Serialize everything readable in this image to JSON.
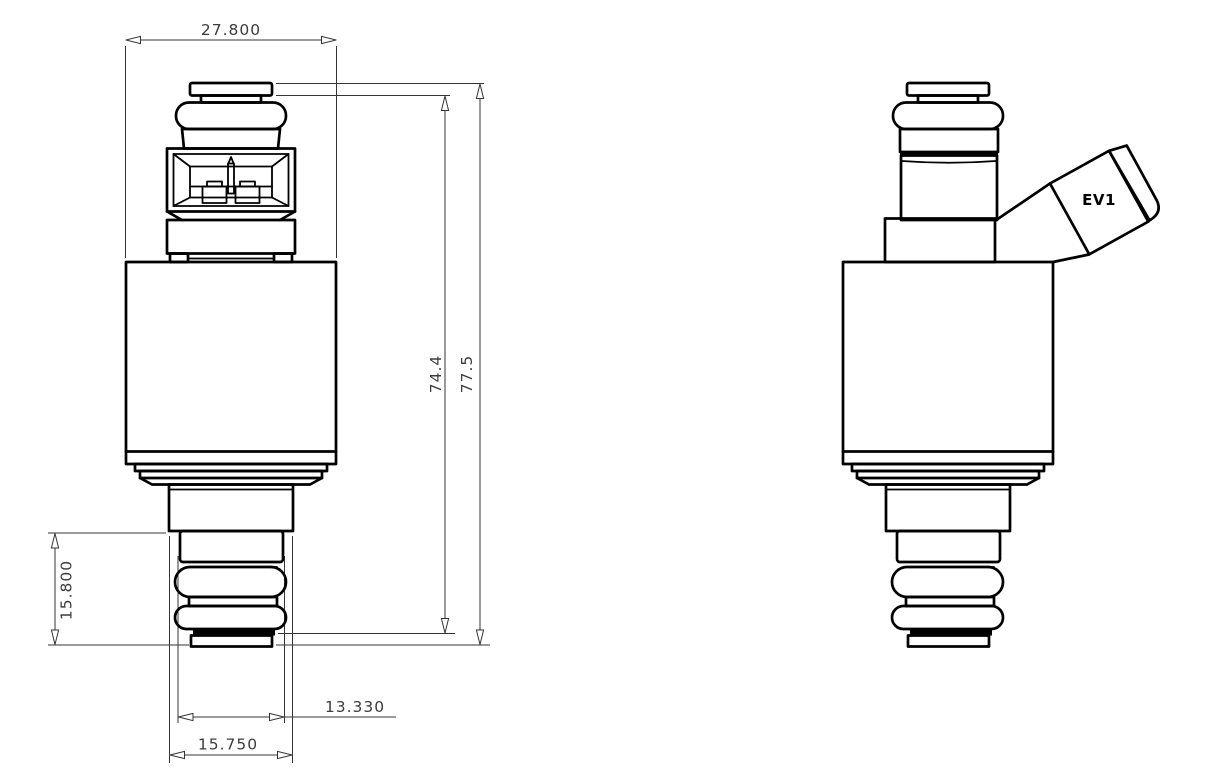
{
  "document": {
    "background_color": "#ffffff",
    "line_color": "#000000",
    "dimension_color": "#3c3c3c",
    "views": {
      "front": {
        "dim_body_width": "27.800",
        "dim_inner_height": "74.4",
        "dim_overall_height": "77.5",
        "dim_lower_length": "15.800",
        "dim_shaft_diameter": "13.330",
        "dim_seal_diameter": "15.750"
      },
      "side": {
        "connector_label": "EV1"
      }
    }
  }
}
